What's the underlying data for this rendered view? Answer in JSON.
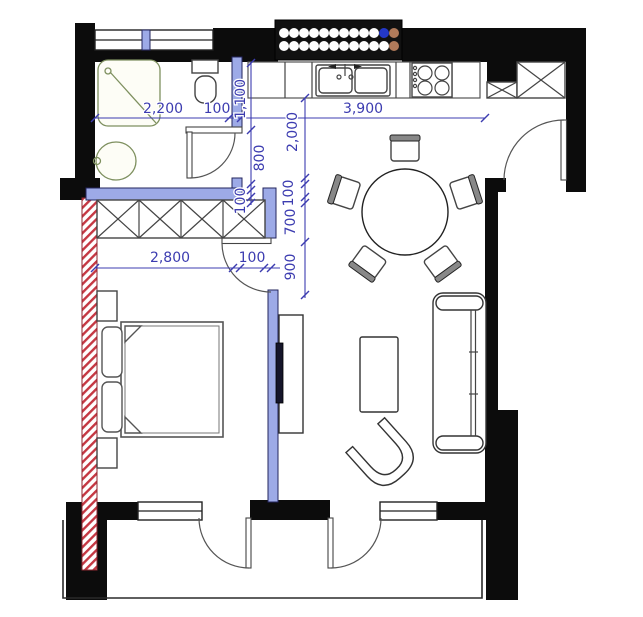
{
  "plan": {
    "kind": "apartment-floor-plan",
    "dimensions": {
      "bath_width": "2,200",
      "top_wall": "100",
      "kitchen_width": "3,900",
      "wc_depth": "1,100",
      "alcove_depth": "800",
      "bath_wall": "100",
      "kitchen_depth": "2,000",
      "closet_wall": "100",
      "closet_depth": "700",
      "doorway_height": "900",
      "bedroom_width": "2,800",
      "door_leaf": "100"
    },
    "colors": {
      "wall_black": "#0c0c0c",
      "partition_blue": "#9daae7",
      "dimension_blue": "#3c3cb0",
      "demolition_red": "#c53742",
      "fixture_olive": "#7e905f",
      "tv_dark": "#15152a",
      "grille_dot_blue": "#2438c8",
      "grille_dot_tan": "#b07a5a"
    }
  }
}
